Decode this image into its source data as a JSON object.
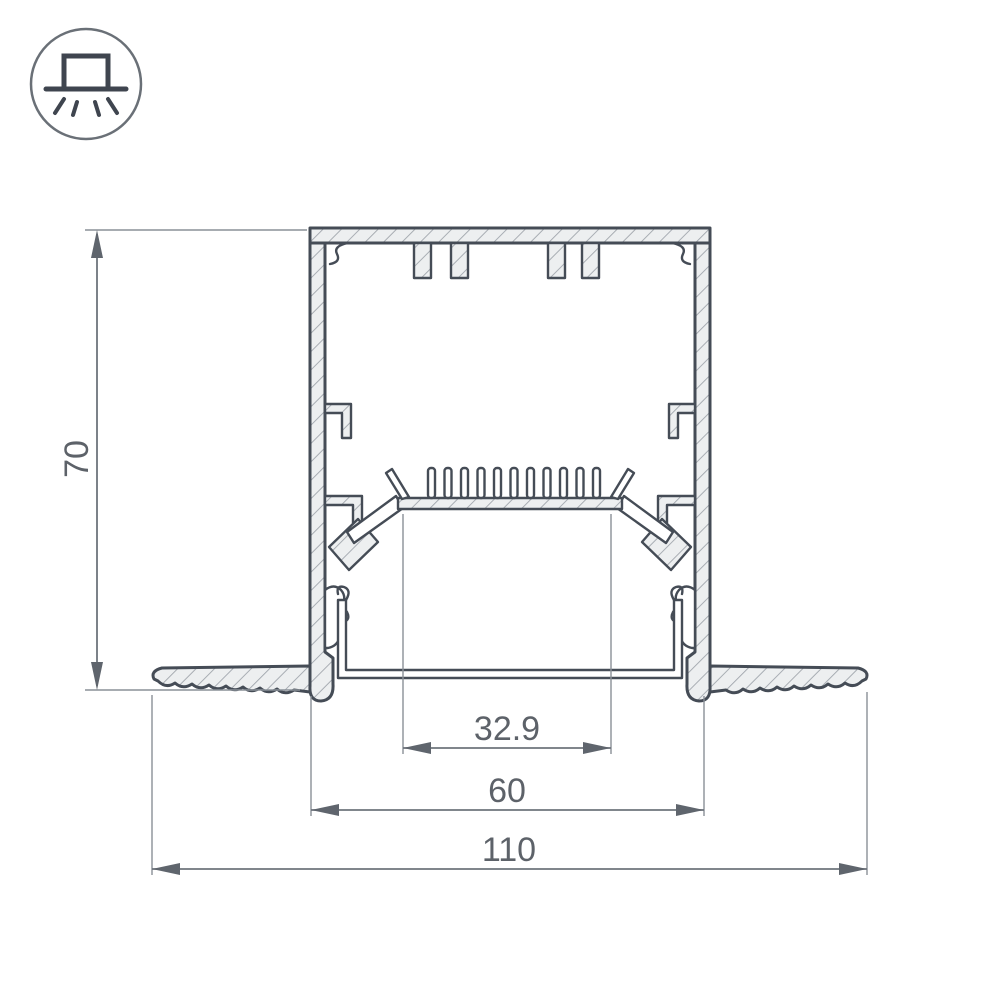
{
  "icon": {
    "name": "recessed-mount-light-icon",
    "description": "circle containing a recessed fixture above a ceiling line with light rays below"
  },
  "drawing": {
    "type": "profile-cross-section",
    "dimensions": {
      "height": "70",
      "inner_window_width": "32.9",
      "body_width": "60",
      "overall_width": "110"
    }
  },
  "colors": {
    "outline": "#454c56",
    "fill": "#edeff0",
    "hatch": "#a1a6ad",
    "dimension_line": "#6e747c",
    "extension_line": "#8a9097",
    "text": "#5d6269",
    "background": "#ffffff"
  }
}
